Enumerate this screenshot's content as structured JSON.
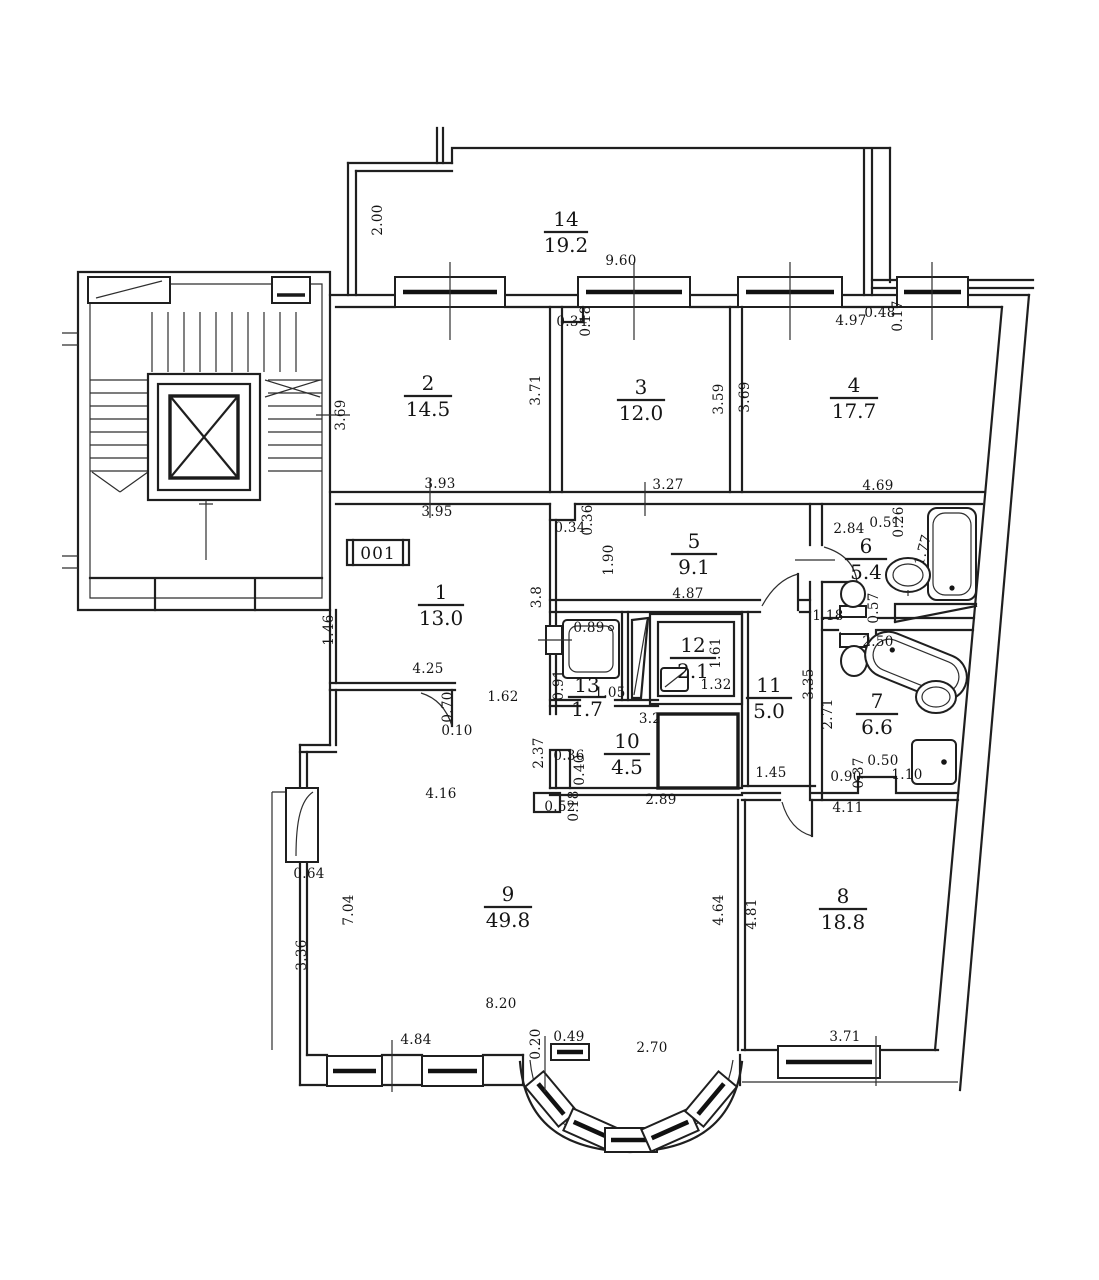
{
  "floor_plan": {
    "stamp": "001",
    "rooms": {
      "r1": {
        "number": "1",
        "area": "13.0"
      },
      "r2": {
        "number": "2",
        "area": "14.5"
      },
      "r3": {
        "number": "3",
        "area": "12.0"
      },
      "r4": {
        "number": "4",
        "area": "17.7"
      },
      "r5": {
        "number": "5",
        "area": "9.1"
      },
      "r6": {
        "number": "6",
        "area": "5.4"
      },
      "r7": {
        "number": "7",
        "area": "6.6"
      },
      "r8": {
        "number": "8",
        "area": "18.8"
      },
      "r9": {
        "number": "9",
        "area": "49.8"
      },
      "r10": {
        "number": "10",
        "area": "4.5"
      },
      "r11": {
        "number": "11",
        "area": "5.0"
      },
      "r12": {
        "number": "12",
        "area": "2.1"
      },
      "r13": {
        "number": "13",
        "area": "1.7"
      },
      "r14": {
        "number": "14",
        "area": "19.2"
      }
    },
    "dims": {
      "r14_left": "2.00",
      "r14_bottom": "9.60",
      "r2_left": "3.69",
      "r2_right": "3.71",
      "r2_bottom_outer": "3.93",
      "r2_bottom_inner": "3.95",
      "r3_top_w": "0.34",
      "r3_top_h": "0.18",
      "r3_right": "3.59",
      "r3_bottom": "3.27",
      "r4_left": "3.69",
      "r4_top": "4.97",
      "r4_top_w": "0.48",
      "r4_top_h": "0.17",
      "r4_bottom": "4.69",
      "r5_notch_w": "0.34",
      "r5_notch_h": "0.36",
      "r5_left": "1.90",
      "r5_bottom": "4.87",
      "r5_wall": "3.8",
      "r6_top": "2.84",
      "r6_top_w": "0.51",
      "r6_top_h": "0.26",
      "r6_tub": "1.77",
      "r6_ledge": "0.57",
      "r6_bottom": "1.18",
      "r13_sink": "0.89",
      "r13_left": "0.91",
      "r13_bottom": "1.05",
      "r12_right": "1.61",
      "r12_bottom": "1.32",
      "r11_right": "3.35",
      "r11_bottom": "1.45",
      "r10_top": "3.2",
      "r10_left": "2.37",
      "r10_notch_w": "0.36",
      "r10_notch_h": "0.40",
      "r10_corner_w": "0.52",
      "r10_corner_h": "0.18",
      "r10_bottom": "2.89",
      "r7_top": "2.50",
      "r7_left": "2.71",
      "r7_b1": "0.90",
      "r7_b2": "0.37",
      "r7_b3": "0.50",
      "r7_b4": "1.10",
      "r8_top": "4.11",
      "r8_left_outer": "4.64",
      "r8_left_inner": "4.81",
      "r8_bottom": "3.71",
      "r1_left": "1.46",
      "r1_bottom": "4.25",
      "r1_door_h": "0.70",
      "r1_door_w": "0.10",
      "r1_opening": "1.62",
      "r9_top": "4.16",
      "r9_door": "0.64",
      "r9_left_upper": "7.04",
      "r9_left_lower": "3.36",
      "r9_inner": "8.20",
      "r9_bottom": "4.84",
      "r9_bay_h": "0.20",
      "r9_bay_w": "0.49",
      "bay_width": "2.70"
    }
  }
}
